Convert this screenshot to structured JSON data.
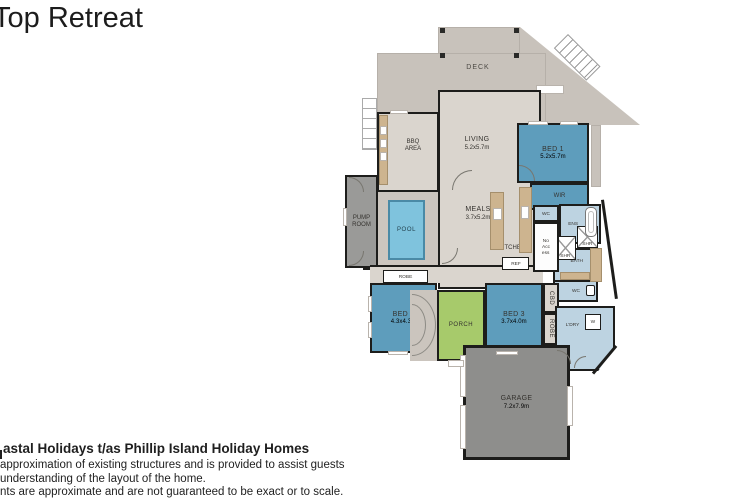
{
  "title": "Top Retreat",
  "footer": {
    "company": "astal Holidays t/as Phillip Island Holiday Homes",
    "line1": "approximation of existing structures and is provided to assist guests",
    "line2": "understanding of the layout of the home.",
    "line3": "nts are approximate and are not guaranteed to be exact or to scale."
  },
  "floorplan": {
    "rooms": {
      "deck": {
        "label": "DECK"
      },
      "bbq": {
        "l1": "BBQ",
        "l2": "AREA"
      },
      "living": {
        "name": "LIVING",
        "dims": "5.2x5.7m"
      },
      "bed1": {
        "name": "BED 1",
        "dims": "5.2x5.7m"
      },
      "wir": {
        "label": "WIR"
      },
      "wc1": {
        "label": "WC"
      },
      "ens": {
        "label": "ENS"
      },
      "shr1": {
        "label": "SHR"
      },
      "shr2": {
        "label": "SHR"
      },
      "bath": {
        "label": "BATH"
      },
      "wc2": {
        "label": "WC"
      },
      "ldry": {
        "label": "L'DRY"
      },
      "washer": {
        "label": "W"
      },
      "cbd": {
        "label": "CBD"
      },
      "robe_bed3": {
        "label": "ROBE"
      },
      "bed3": {
        "name": "BED 3",
        "dims": "3.7x4.0m"
      },
      "porch": {
        "label": "PORCH"
      },
      "bed2": {
        "name": "BED 2",
        "dims": "4.3x4.3m"
      },
      "robe_bed2": {
        "label": "ROBE"
      },
      "pool": {
        "label": "POOL"
      },
      "pump": {
        "l1": "PUMP",
        "l2": "ROOM"
      },
      "meals": {
        "name": "MEALS",
        "dims": "3.7x5.2m"
      },
      "kitchen": {
        "label": "KITCHEN"
      },
      "ref": {
        "label": "REF"
      },
      "no_access": {
        "l1": "No",
        "l2": "Acc",
        "l3": "ess"
      },
      "garage": {
        "name": "GARAGE",
        "dims": "7.2x7.9m"
      }
    },
    "colors": {
      "wall": "#1d1d1b",
      "deck": "#c8c2bb",
      "floor": "#dad5ce",
      "room-blue": "#5e9dbc",
      "pool-water": "#7fc3dd",
      "bath-blue": "#bdd3e1",
      "porch-green": "#a7ca6b",
      "garage-gray": "#8e8e8c",
      "pump-gray": "#9a9a98",
      "bench-tan": "#cdb48f"
    }
  }
}
